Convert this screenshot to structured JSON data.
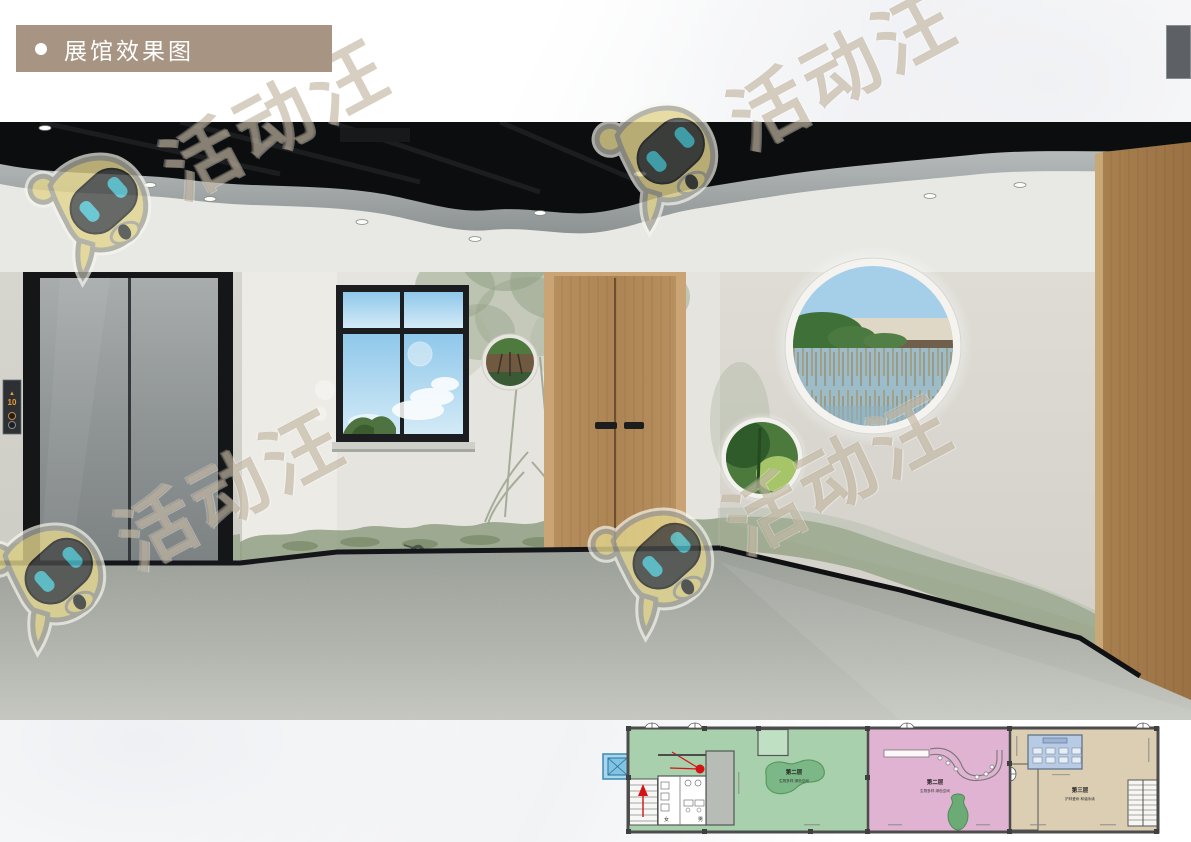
{
  "header": {
    "bullet": "●",
    "title": "展馆效果图",
    "box_color": "#a79482"
  },
  "page_tab": {
    "color": "#5d6065"
  },
  "watermark": {
    "text": "活动汪",
    "text_color": "#ac9b7e",
    "mascot_body_color": "#e3d68e",
    "mascot_eye_color": "#4ec1ce"
  },
  "rendering": {
    "elevator_display_arrow": "▲",
    "elevator_display_floor": "10",
    "display_color": "#f09a36"
  },
  "floor_plan": {
    "sections": [
      {
        "id": "green",
        "title": "第二层",
        "subtitle": "生物多样 绿色空间",
        "color": "#a8d0ad"
      },
      {
        "id": "pink",
        "title": "第二层",
        "subtitle": "生物多样 绿色空间",
        "color": "#dfb3d1"
      },
      {
        "id": "tan",
        "title": "第三层",
        "subtitle": "护林爱树 和谐永续",
        "color": "#dbceb2"
      }
    ],
    "labels": {
      "female": "女",
      "male": "男"
    },
    "annotation_color": "#d41414",
    "elevator_symbol_color": "#a5d8f0",
    "meeting_room_color": "#b7cbe4"
  }
}
